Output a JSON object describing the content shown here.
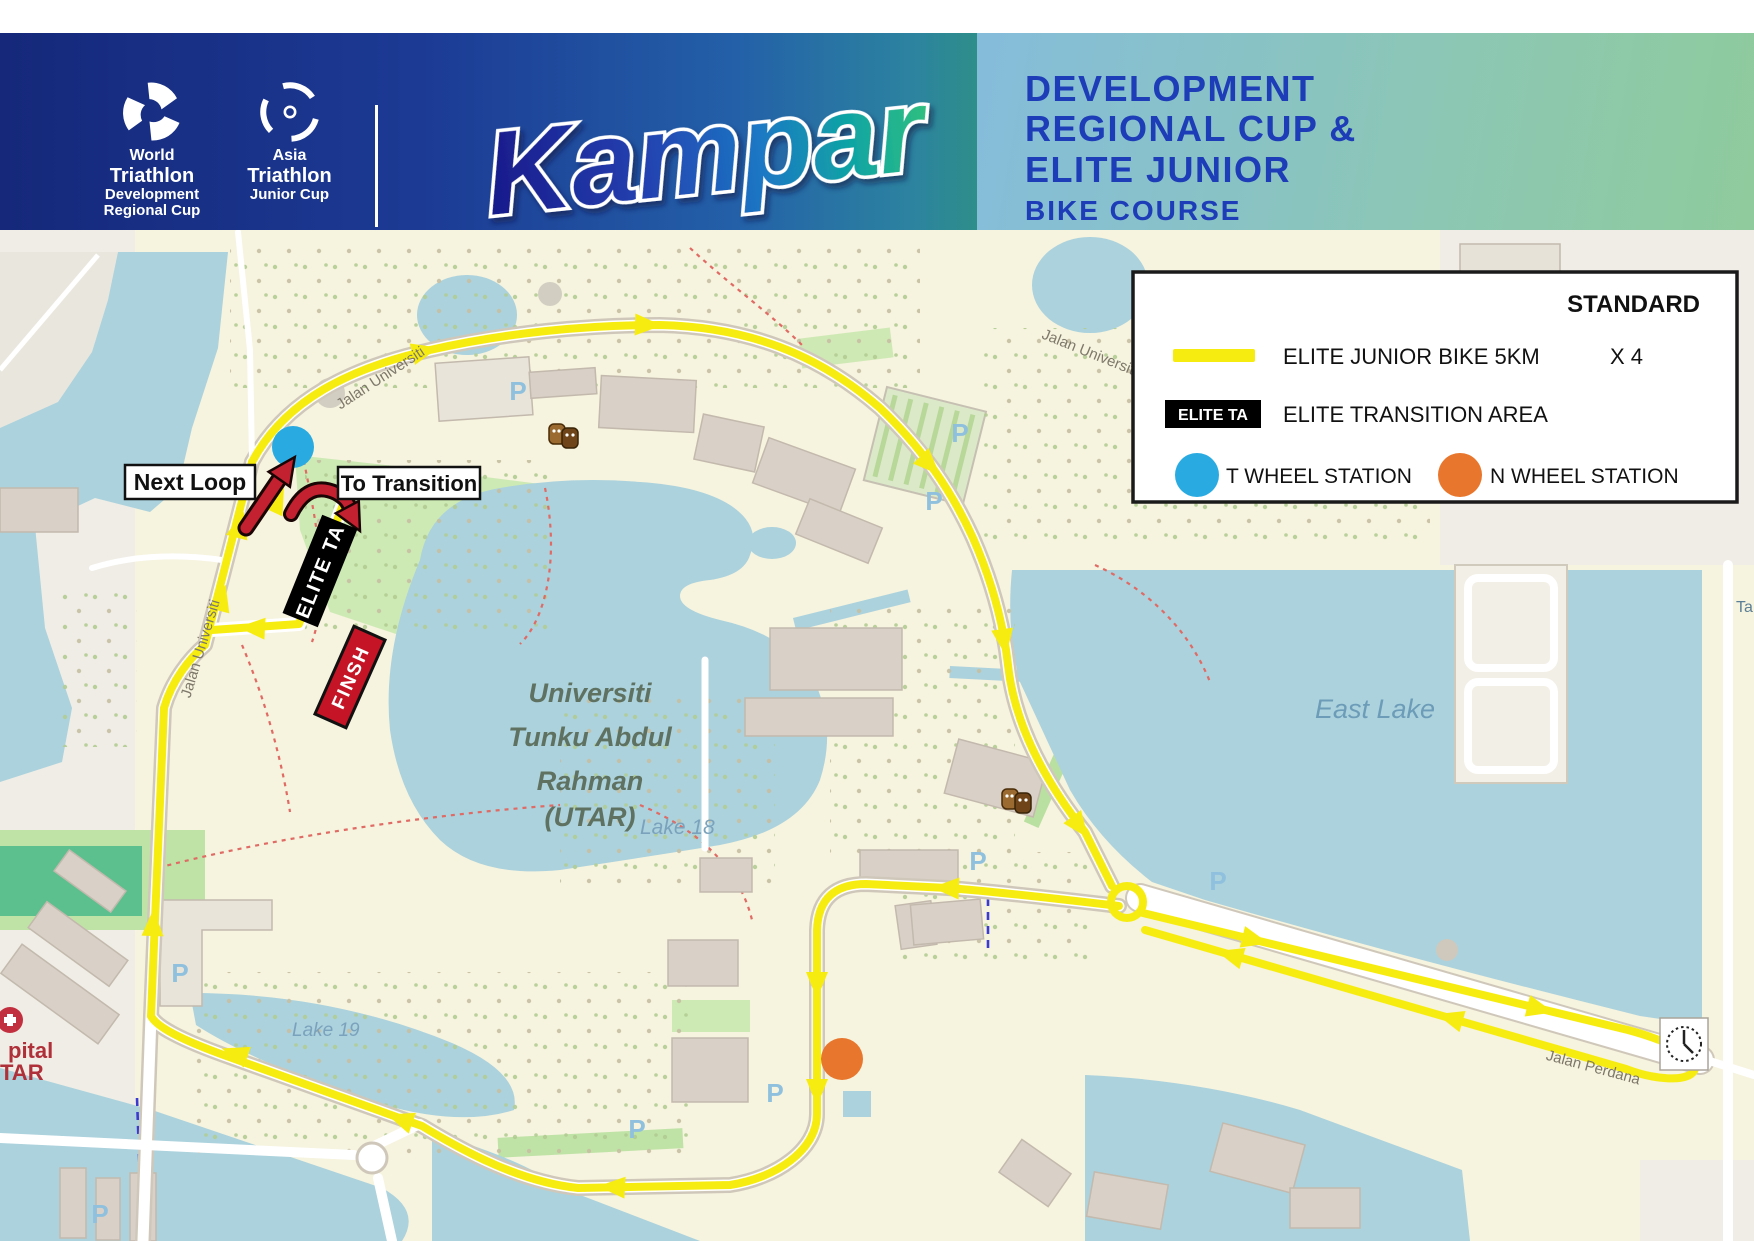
{
  "header": {
    "logos": {
      "world": {
        "lines": [
          "World",
          "Triathlon",
          "Development",
          "Regional Cup"
        ]
      },
      "asia": {
        "lines": [
          "Asia",
          "Triathlon",
          "Junior Cup"
        ]
      }
    },
    "wordmark": {
      "text": "Kampar",
      "region": "PERAK • MALAYSIA",
      "venue": "UTAR KAMPAR",
      "dates": "11-14 JUNE 2026"
    },
    "title": {
      "line1": "DEVELOPMENT",
      "line2": "REGIONAL CUP &",
      "line3": "ELITE JUNIOR",
      "subtitle": "BIKE COURSE"
    }
  },
  "legend": {
    "heading": "STANDARD",
    "route": {
      "label": "ELITE JUNIOR BIKE 5KM",
      "laps": "X 4"
    },
    "transition": {
      "badge": "ELITE TA",
      "label": "ELITE TRANSITION AREA"
    },
    "wheel_stations": [
      {
        "label": "T WHEEL STATION",
        "color": "#29abe2"
      },
      {
        "label": "N WHEEL STATION",
        "color": "#e8762c"
      }
    ]
  },
  "map": {
    "callouts": {
      "next_loop": "Next Loop",
      "to_transition": "To Transition",
      "elite_ta": "ELITE TA",
      "finish": "FINSH"
    },
    "places": {
      "utar_lines": [
        "Universiti",
        "Tunku Abdul",
        "Rahman",
        "(UTAR)"
      ],
      "lake18": "Lake 18",
      "lake19": "Lake 19",
      "east_lake": "East Lake",
      "hospital_line1": "pital",
      "hospital_line2": "TAR",
      "street_universiti": "Jalan Universiti",
      "street_perdana": "Jalan Perdana",
      "street_cut": "Ta",
      "parking": "P"
    },
    "colors": {
      "course": "#f7ec0f",
      "t_wheel": "#29abe2",
      "n_wheel": "#e8762c",
      "finish_red": "#c41425",
      "water": "#abd2dd"
    }
  }
}
